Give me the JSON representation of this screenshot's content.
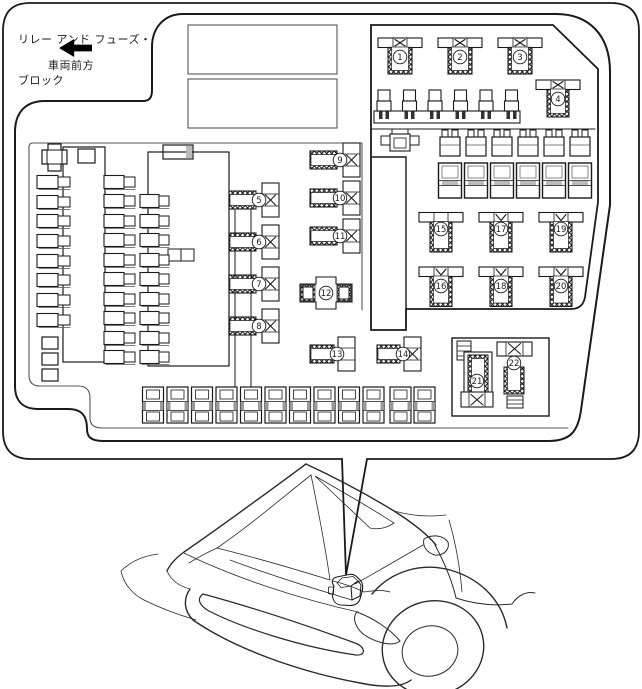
{
  "title": {
    "line1": "リレー アンド フューズ・",
    "line2": "ブロック"
  },
  "front_direction_label": "車両前方",
  "relays": [
    {
      "label": "1"
    },
    {
      "label": "2"
    },
    {
      "label": "3"
    },
    {
      "label": "4"
    },
    {
      "label": "5"
    },
    {
      "label": "6"
    },
    {
      "label": "7"
    },
    {
      "label": "8"
    },
    {
      "label": "9"
    },
    {
      "label": "10"
    },
    {
      "label": "11"
    },
    {
      "label": "12"
    },
    {
      "label": "13"
    },
    {
      "label": "14"
    },
    {
      "label": "15"
    },
    {
      "label": "16"
    },
    {
      "label": "17"
    },
    {
      "label": "18"
    },
    {
      "label": "19"
    },
    {
      "label": "20"
    },
    {
      "label": "21"
    },
    {
      "label": "22"
    }
  ],
  "colors": {
    "line": "#1a1a1a",
    "highlight_fill": "#2e66ae",
    "highlight_top": "#7ea4d6",
    "highlight_side": "#1c4a8c",
    "highlight_outline": "#16396f"
  }
}
